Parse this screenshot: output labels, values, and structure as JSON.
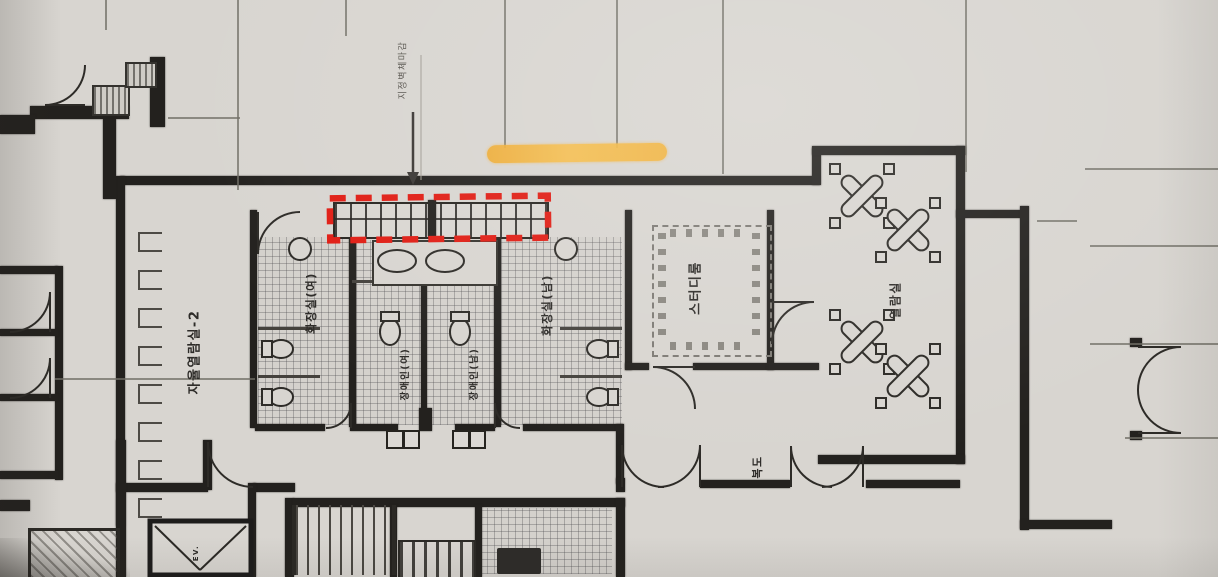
{
  "scene": {
    "description": "Photographed architectural floor plan with highlighter and red marker annotations"
  },
  "rooms": {
    "free_reading_room": "자율열람실-2",
    "toilet_women": "화장실(여)",
    "toilet_men": "화장실(남)",
    "accessible_toilet_women": "장애인(여)",
    "accessible_toilet_men": "장애인(남)",
    "study_room": "스터디룸",
    "reading_room": "열람실",
    "corridor": "복도",
    "elevator": "EV."
  },
  "annotations": {
    "wall_note": "지정벽체마감",
    "highlight_color": "#f3b244",
    "marker_box_color": "#e01c13"
  }
}
